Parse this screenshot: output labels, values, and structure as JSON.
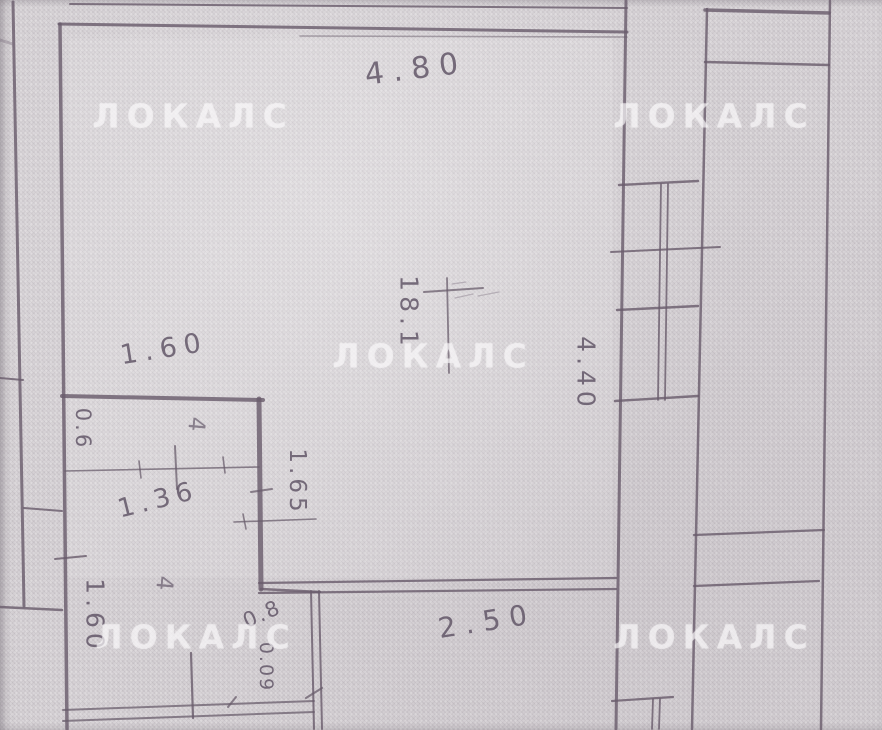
{
  "watermark": {
    "text": "ЛОКАЛС"
  },
  "labels": {
    "width_top": "4.80",
    "width_closet": "1.60",
    "area_room": "18.1",
    "height_room": "4.40",
    "height_hall": "1.60",
    "closet_depth": "0.6",
    "closet_inner": "1.36",
    "wall_side": "1.65",
    "width_bottom": "2.50",
    "opening_a": "0.8",
    "opening_b": "0.09",
    "mark_a": "4",
    "mark_b": "4"
  },
  "colors": {
    "paper": "#d8d4d7",
    "ink": "#6a5d6c",
    "handwriting": "#5e5264",
    "watermark": "rgba(250,248,250,0.6)"
  }
}
